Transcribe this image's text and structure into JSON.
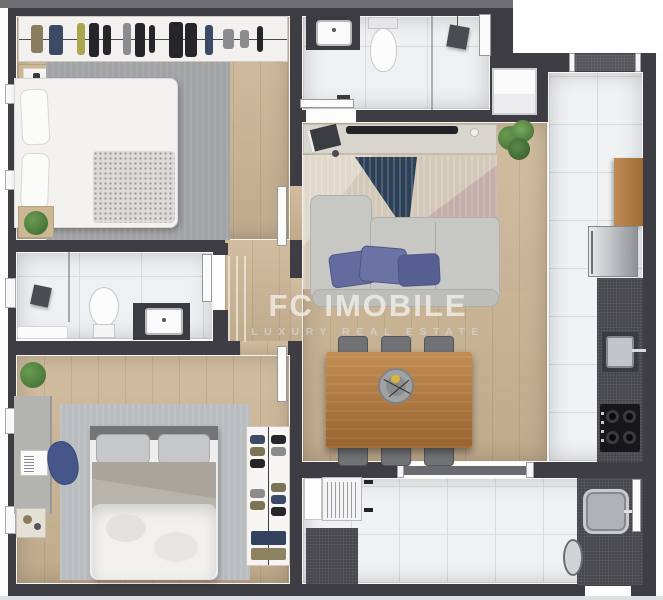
{
  "watermark": {
    "title": "FC IMOBILE",
    "subtitle": "LUXURY REAL ESTATE"
  },
  "colors": {
    "wall": "#3e3d43",
    "exterior_top": "#6e6f73",
    "exterior_bottom": "#dfe0e3",
    "wood_floor": "#ccb595",
    "wood_cabinet": "#b5834f",
    "wood_table": "#b3783f",
    "tile": "#f0f1f3",
    "tile_line": "#d9dadd",
    "bath_tile": "#eef0f2",
    "rug_bedroom1": "#a2a3a5",
    "rug_bedroom2": "#b9bdbf",
    "rug_living": "#d3c8ba",
    "rug_navy": "#2c4157",
    "rug_mauve": "#c2aaa8",
    "sofa": "#c7c8c4",
    "pillow_blue": "#646b9e",
    "counter_dark": "#46474c",
    "steel": "#c7c9cc",
    "plant_green": "#4f7c3e",
    "desk_chair_blue": "#46568a",
    "watermark_text": "#f3efe9",
    "watermark_sub": "#d8d6d3"
  }
}
